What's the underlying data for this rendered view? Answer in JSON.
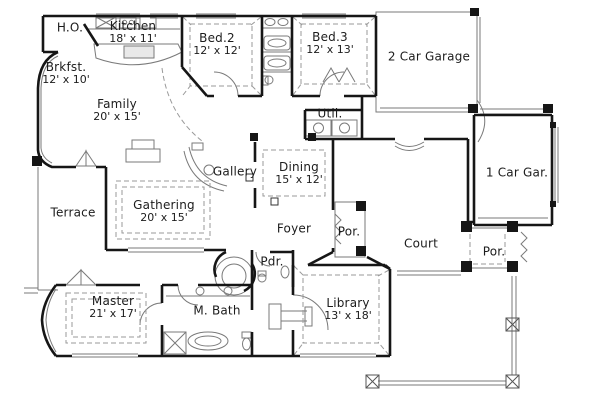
{
  "drawing": {
    "type": "architectural-floor-plan",
    "colors": {
      "wall": "#161616",
      "thin_line": "#7a7a7a",
      "dashed_line": "#9a9a9a",
      "text": "#1c1c1c",
      "background": "#ffffff"
    }
  },
  "rooms": [
    {
      "id": "ho",
      "name": "H.O.",
      "dims": ""
    },
    {
      "id": "kitchen",
      "name": "Kitchen",
      "dims": "18' x 11'"
    },
    {
      "id": "bed2",
      "name": "Bed.2",
      "dims": "12' x 12'"
    },
    {
      "id": "bed3",
      "name": "Bed.3",
      "dims": "12' x 13'"
    },
    {
      "id": "garage2",
      "name": "2 Car Garage",
      "dims": ""
    },
    {
      "id": "brkfst",
      "name": "Brkfst.",
      "dims": "12' x 10'"
    },
    {
      "id": "family",
      "name": "Family",
      "dims": "20' x 15'"
    },
    {
      "id": "util",
      "name": "Util.",
      "dims": ""
    },
    {
      "id": "gallery",
      "name": "Gallery",
      "dims": ""
    },
    {
      "id": "dining",
      "name": "Dining",
      "dims": "15' x 12'"
    },
    {
      "id": "garage1",
      "name": "1 Car Gar.",
      "dims": ""
    },
    {
      "id": "terrace",
      "name": "Terrace",
      "dims": ""
    },
    {
      "id": "gathering",
      "name": "Gathering",
      "dims": "20' x 15'"
    },
    {
      "id": "foyer",
      "name": "Foyer",
      "dims": ""
    },
    {
      "id": "por-front",
      "name": "Por.",
      "dims": ""
    },
    {
      "id": "court",
      "name": "Court",
      "dims": ""
    },
    {
      "id": "por-right",
      "name": "Por.",
      "dims": ""
    },
    {
      "id": "pdr",
      "name": "Pdr.",
      "dims": ""
    },
    {
      "id": "master",
      "name": "Master",
      "dims": "21' x 17'"
    },
    {
      "id": "mbath",
      "name": "M. Bath",
      "dims": ""
    },
    {
      "id": "library",
      "name": "Library",
      "dims": "13' x 18'"
    }
  ]
}
